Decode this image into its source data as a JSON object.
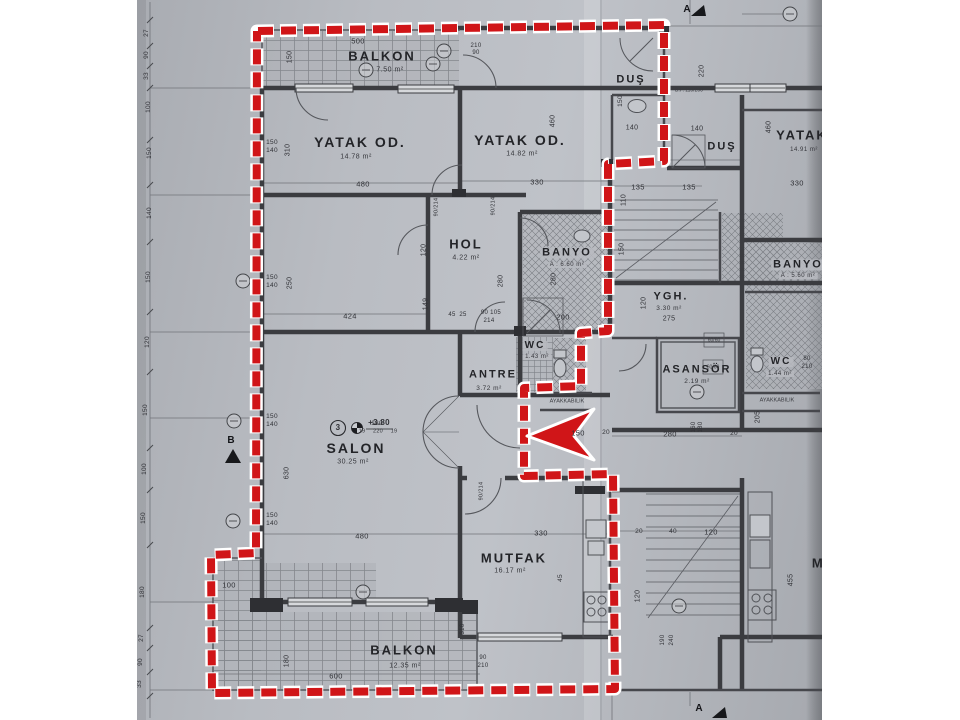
{
  "document": {
    "type": "architectural-floor-plan-photo",
    "red_accent": "#d01518",
    "paper_color": "#b6b9bf",
    "line_color": "#3b3c40",
    "highlighted_unit_rooms": [
      "BALKON",
      "YATAK OD.",
      "YATAK OD.",
      "DUŞ",
      "HOL",
      "BANYO",
      "WC",
      "ANTRE",
      "SALON",
      "MUTFAK",
      "BALKON"
    ],
    "section_markers": [
      "A",
      "A",
      "B"
    ],
    "level_note": "+3.80",
    "unit_number": "3"
  },
  "plan": {
    "labels": [
      {
        "t": "BALKON",
        "x": 382,
        "y": 56,
        "s": 13,
        "c": "room"
      },
      {
        "t": "7.50 m²",
        "x": 390,
        "y": 70,
        "s": 7,
        "c": "area"
      },
      {
        "t": "YATAK OD.",
        "x": 360,
        "y": 142,
        "s": 14,
        "c": "room"
      },
      {
        "t": "14.78 m²",
        "x": 356,
        "y": 157,
        "s": 7,
        "c": "area"
      },
      {
        "t": "YATAK OD.",
        "x": 520,
        "y": 140,
        "s": 14,
        "c": "room"
      },
      {
        "t": "14.82 m²",
        "x": 522,
        "y": 154,
        "s": 7,
        "c": "area"
      },
      {
        "t": "DUŞ",
        "x": 631,
        "y": 80,
        "s": 11,
        "c": "room"
      },
      {
        "t": "DUŞ",
        "x": 722,
        "y": 147,
        "s": 11,
        "c": "room"
      },
      {
        "t": "HOL",
        "x": 466,
        "y": 244,
        "s": 13,
        "c": "room"
      },
      {
        "t": "4.22 m²",
        "x": 466,
        "y": 258,
        "s": 7,
        "c": "area"
      },
      {
        "t": "BANYO",
        "x": 567,
        "y": 253,
        "s": 11,
        "c": "room bg"
      },
      {
        "t": "A : 6.60 m²",
        "x": 567,
        "y": 265,
        "s": 6,
        "c": "area bg"
      },
      {
        "t": "YGH.",
        "x": 671,
        "y": 297,
        "s": 11,
        "c": "room"
      },
      {
        "t": "3.30 m²",
        "x": 669,
        "y": 309,
        "s": 6.5,
        "c": "area"
      },
      {
        "t": "275",
        "x": 669,
        "y": 319,
        "s": 7,
        "c": "dim"
      },
      {
        "t": "WC",
        "x": 535,
        "y": 346,
        "s": 10,
        "c": "room bg"
      },
      {
        "t": "1.43 m²",
        "x": 537,
        "y": 357,
        "s": 6,
        "c": "area bg"
      },
      {
        "t": "ANTRE",
        "x": 493,
        "y": 375,
        "s": 11,
        "c": "room"
      },
      {
        "t": "3.72 m²",
        "x": 489,
        "y": 389,
        "s": 6.5,
        "c": "area"
      },
      {
        "t": "AYAKKABILIK",
        "x": 567,
        "y": 402,
        "s": 5.5,
        "c": "tiny"
      },
      {
        "t": "ASANSÖR",
        "x": 697,
        "y": 370,
        "s": 11,
        "c": "room"
      },
      {
        "t": "2.19 m²",
        "x": 697,
        "y": 382,
        "s": 6.5,
        "c": "area"
      },
      {
        "t": "WC",
        "x": 781,
        "y": 362,
        "s": 10,
        "c": "room bg"
      },
      {
        "t": "1.44 m²",
        "x": 780,
        "y": 374,
        "s": 6,
        "c": "area bg"
      },
      {
        "t": "BANYO",
        "x": 798,
        "y": 265,
        "s": 11,
        "c": "room bg"
      },
      {
        "t": "A : 5.60 m²",
        "x": 798,
        "y": 276,
        "s": 6,
        "c": "area bg"
      },
      {
        "t": "AYAKKABILIK",
        "x": 777,
        "y": 401,
        "s": 5.5,
        "c": "tiny"
      },
      {
        "t": "SALON",
        "x": 356,
        "y": 448,
        "s": 14,
        "c": "room"
      },
      {
        "t": "30.25 m²",
        "x": 353,
        "y": 462,
        "s": 7,
        "c": "area"
      },
      {
        "t": "+3.80",
        "x": 379,
        "y": 423,
        "s": 8,
        "c": "dim",
        "w": 700
      },
      {
        "t": "MUTFAK",
        "x": 514,
        "y": 558,
        "s": 13,
        "c": "room"
      },
      {
        "t": "16.17 m²",
        "x": 510,
        "y": 571,
        "s": 7,
        "c": "area"
      },
      {
        "t": "BALKON",
        "x": 404,
        "y": 650,
        "s": 13,
        "c": "room"
      },
      {
        "t": "12.35 m²",
        "x": 405,
        "y": 666,
        "s": 7,
        "c": "area"
      },
      {
        "t": "YATAK",
        "x": 802,
        "y": 135,
        "s": 13,
        "c": "room"
      },
      {
        "t": "14.91 m²",
        "x": 804,
        "y": 150,
        "s": 6,
        "c": "area"
      },
      {
        "t": "MUTFAK",
        "x": 845,
        "y": 563,
        "s": 13,
        "c": "room"
      },
      {
        "t": "3",
        "x": 338,
        "y": 428,
        "s": 8,
        "c": "dim",
        "w": 700
      },
      {
        "t": "500",
        "x": 358,
        "y": 41,
        "s": 7.5,
        "c": "dim"
      },
      {
        "t": "150",
        "x": 290,
        "y": 57,
        "s": 7,
        "c": "dim",
        "r": 1
      },
      {
        "t": "210",
        "x": 476,
        "y": 46,
        "s": 6,
        "c": "dim"
      },
      {
        "t": "90",
        "x": 476,
        "y": 53,
        "s": 6,
        "c": "dim"
      },
      {
        "t": "480",
        "x": 363,
        "y": 184,
        "s": 7.5,
        "c": "dim"
      },
      {
        "t": "330",
        "x": 537,
        "y": 182,
        "s": 7.5,
        "c": "dim"
      },
      {
        "t": "310",
        "x": 288,
        "y": 150,
        "s": 7,
        "c": "dim",
        "r": 1
      },
      {
        "t": "150",
        "x": 272,
        "y": 143,
        "s": 6.5,
        "c": "dim"
      },
      {
        "t": "140",
        "x": 272,
        "y": 151,
        "s": 6.5,
        "c": "dim"
      },
      {
        "t": "460",
        "x": 553,
        "y": 121,
        "s": 7,
        "c": "dim",
        "r": 1
      },
      {
        "t": "460",
        "x": 769,
        "y": 127,
        "s": 7,
        "c": "dim",
        "r": 1
      },
      {
        "t": "330",
        "x": 797,
        "y": 183,
        "s": 7.5,
        "c": "dim"
      },
      {
        "t": "140",
        "x": 632,
        "y": 128,
        "s": 7,
        "c": "dim"
      },
      {
        "t": "140",
        "x": 697,
        "y": 129,
        "s": 7,
        "c": "dim"
      },
      {
        "t": "150",
        "x": 621,
        "y": 101,
        "s": 6.5,
        "c": "dim",
        "r": 1
      },
      {
        "t": "220",
        "x": 702,
        "y": 71,
        "s": 7,
        "c": "dim",
        "r": 1
      },
      {
        "t": "B.P. 110/200",
        "x": 689,
        "y": 91,
        "s": 5,
        "c": "tiny"
      },
      {
        "t": "135",
        "x": 638,
        "y": 187,
        "s": 7.5,
        "c": "dim"
      },
      {
        "t": "135",
        "x": 689,
        "y": 187,
        "s": 7.5,
        "c": "dim"
      },
      {
        "t": "110",
        "x": 624,
        "y": 200,
        "s": 7,
        "c": "dim",
        "r": 1
      },
      {
        "t": "150",
        "x": 622,
        "y": 249,
        "s": 7,
        "c": "dim",
        "r": 1
      },
      {
        "t": "90/214",
        "x": 437,
        "y": 207,
        "s": 5.5,
        "c": "dim",
        "r": 1
      },
      {
        "t": "90/214",
        "x": 494,
        "y": 206,
        "s": 5.5,
        "c": "dim",
        "r": 1
      },
      {
        "t": "120",
        "x": 424,
        "y": 250,
        "s": 7,
        "c": "dim",
        "r": 1
      },
      {
        "t": "280",
        "x": 501,
        "y": 281,
        "s": 7,
        "c": "dim",
        "r": 1
      },
      {
        "t": "280",
        "x": 554,
        "y": 279,
        "s": 7,
        "c": "dim",
        "r": 1
      },
      {
        "t": "424",
        "x": 350,
        "y": 316,
        "s": 7.5,
        "c": "dim"
      },
      {
        "t": "45",
        "x": 452,
        "y": 315,
        "s": 6,
        "c": "dim"
      },
      {
        "t": "25",
        "x": 463,
        "y": 315,
        "s": 6,
        "c": "dim"
      },
      {
        "t": "90 105",
        "x": 491,
        "y": 313,
        "s": 6,
        "c": "dim"
      },
      {
        "t": "214",
        "x": 489,
        "y": 321,
        "s": 6,
        "c": "dim"
      },
      {
        "t": "200",
        "x": 563,
        "y": 317,
        "s": 7.5,
        "c": "dim"
      },
      {
        "t": "150",
        "x": 272,
        "y": 278,
        "s": 6.5,
        "c": "dim"
      },
      {
        "t": "140",
        "x": 272,
        "y": 286,
        "s": 6.5,
        "c": "dim"
      },
      {
        "t": "250",
        "x": 290,
        "y": 283,
        "s": 7,
        "c": "dim",
        "r": 1
      },
      {
        "t": "150",
        "x": 272,
        "y": 417,
        "s": 6.5,
        "c": "dim"
      },
      {
        "t": "140",
        "x": 272,
        "y": 425,
        "s": 6.5,
        "c": "dim"
      },
      {
        "t": "630",
        "x": 287,
        "y": 473,
        "s": 7,
        "c": "dim",
        "r": 1
      },
      {
        "t": "150",
        "x": 272,
        "y": 516,
        "s": 6.5,
        "c": "dim"
      },
      {
        "t": "140",
        "x": 272,
        "y": 524,
        "s": 6.5,
        "c": "dim"
      },
      {
        "t": "149",
        "x": 426,
        "y": 304,
        "s": 7,
        "c": "dim",
        "r": 1
      },
      {
        "t": "180",
        "x": 377,
        "y": 424,
        "s": 6.5,
        "c": "dim"
      },
      {
        "t": "19",
        "x": 362,
        "y": 432,
        "s": 5.5,
        "c": "dim"
      },
      {
        "t": "220",
        "x": 378,
        "y": 432,
        "s": 5.5,
        "c": "dim"
      },
      {
        "t": "19",
        "x": 394,
        "y": 432,
        "s": 5.5,
        "c": "dim"
      },
      {
        "t": "150",
        "x": 578,
        "y": 433,
        "s": 7.5,
        "c": "dim"
      },
      {
        "t": "20",
        "x": 606,
        "y": 433,
        "s": 6.5,
        "c": "dim"
      },
      {
        "t": "480",
        "x": 362,
        "y": 536,
        "s": 7.5,
        "c": "dim"
      },
      {
        "t": "330",
        "x": 541,
        "y": 533,
        "s": 7.5,
        "c": "dim"
      },
      {
        "t": "45",
        "x": 561,
        "y": 578,
        "s": 6.5,
        "c": "dim",
        "r": 1
      },
      {
        "t": "90/214",
        "x": 482,
        "y": 491,
        "s": 5.5,
        "c": "dim",
        "r": 1
      },
      {
        "t": "120",
        "x": 644,
        "y": 303,
        "s": 7,
        "c": "dim",
        "r": 1
      },
      {
        "t": "280",
        "x": 670,
        "y": 434,
        "s": 7.5,
        "c": "dim"
      },
      {
        "t": "160",
        "x": 694,
        "y": 427,
        "s": 6,
        "c": "dim",
        "r": 1
      },
      {
        "t": "180",
        "x": 701,
        "y": 427,
        "s": 6,
        "c": "dim",
        "r": 1
      },
      {
        "t": "20",
        "x": 734,
        "y": 434,
        "s": 6.5,
        "c": "dim"
      },
      {
        "t": "205",
        "x": 758,
        "y": 417,
        "s": 7,
        "c": "dim",
        "r": 1
      },
      {
        "t": "60/60",
        "x": 714,
        "y": 341,
        "s": 5,
        "c": "tiny"
      },
      {
        "t": "60/60",
        "x": 713,
        "y": 368,
        "s": 5,
        "c": "tiny"
      },
      {
        "t": "80",
        "x": 807,
        "y": 359,
        "s": 6,
        "c": "dim"
      },
      {
        "t": "210",
        "x": 807,
        "y": 367,
        "s": 6,
        "c": "dim"
      },
      {
        "t": "100",
        "x": 229,
        "y": 585,
        "s": 7.5,
        "c": "dim"
      },
      {
        "t": "180",
        "x": 287,
        "y": 661,
        "s": 7,
        "c": "dim",
        "r": 1
      },
      {
        "t": "600",
        "x": 336,
        "y": 676,
        "s": 7.5,
        "c": "dim"
      },
      {
        "t": "90",
        "x": 483,
        "y": 658,
        "s": 6,
        "c": "dim"
      },
      {
        "t": "210",
        "x": 483,
        "y": 666,
        "s": 6,
        "c": "dim"
      },
      {
        "t": "20",
        "x": 639,
        "y": 532,
        "s": 6.5,
        "c": "dim"
      },
      {
        "t": "40",
        "x": 673,
        "y": 532,
        "s": 6.5,
        "c": "dim"
      },
      {
        "t": "120",
        "x": 711,
        "y": 532,
        "s": 7.5,
        "c": "dim"
      },
      {
        "t": "120",
        "x": 638,
        "y": 596,
        "s": 7,
        "c": "dim",
        "r": 1
      },
      {
        "t": "190",
        "x": 663,
        "y": 640,
        "s": 6,
        "c": "dim",
        "r": 1
      },
      {
        "t": "240",
        "x": 672,
        "y": 640,
        "s": 6,
        "c": "dim",
        "r": 1
      },
      {
        "t": "455",
        "x": 791,
        "y": 580,
        "s": 7,
        "c": "dim",
        "r": 1
      },
      {
        "t": "310",
        "x": 463,
        "y": 629,
        "s": 6,
        "c": "dim",
        "r": 1
      },
      {
        "t": "27",
        "x": 147,
        "y": 33,
        "s": 6.5,
        "c": "dim",
        "r": 1
      },
      {
        "t": "90",
        "x": 147,
        "y": 55,
        "s": 6.5,
        "c": "dim",
        "r": 1
      },
      {
        "t": "33",
        "x": 147,
        "y": 76,
        "s": 6.5,
        "c": "dim",
        "r": 1
      },
      {
        "t": "100",
        "x": 149,
        "y": 107,
        "s": 6.5,
        "c": "dim",
        "r": 1
      },
      {
        "t": "150",
        "x": 150,
        "y": 153,
        "s": 6.5,
        "c": "dim",
        "r": 1
      },
      {
        "t": "140",
        "x": 150,
        "y": 213,
        "s": 6.5,
        "c": "dim",
        "r": 1
      },
      {
        "t": "150",
        "x": 149,
        "y": 277,
        "s": 6.5,
        "c": "dim",
        "r": 1
      },
      {
        "t": "120",
        "x": 148,
        "y": 342,
        "s": 6.5,
        "c": "dim",
        "r": 1
      },
      {
        "t": "150",
        "x": 146,
        "y": 410,
        "s": 6.5,
        "c": "dim",
        "r": 1
      },
      {
        "t": "100",
        "x": 145,
        "y": 469,
        "s": 6.5,
        "c": "dim",
        "r": 1
      },
      {
        "t": "150",
        "x": 144,
        "y": 518,
        "s": 6.5,
        "c": "dim",
        "r": 1
      },
      {
        "t": "180",
        "x": 143,
        "y": 592,
        "s": 6.5,
        "c": "dim",
        "r": 1
      },
      {
        "t": "27",
        "x": 142,
        "y": 638,
        "s": 6.5,
        "c": "dim",
        "r": 1
      },
      {
        "t": "90",
        "x": 141,
        "y": 662,
        "s": 6.5,
        "c": "dim",
        "r": 1
      },
      {
        "t": "33",
        "x": 140,
        "y": 684,
        "s": 6.5,
        "c": "dim",
        "r": 1
      },
      {
        "t": "A",
        "x": 687,
        "y": 10,
        "s": 10,
        "c": "marker"
      },
      {
        "t": "A",
        "x": 699,
        "y": 709,
        "s": 10,
        "c": "marker"
      },
      {
        "t": "B",
        "x": 231,
        "y": 441,
        "s": 10,
        "c": "marker"
      }
    ]
  }
}
